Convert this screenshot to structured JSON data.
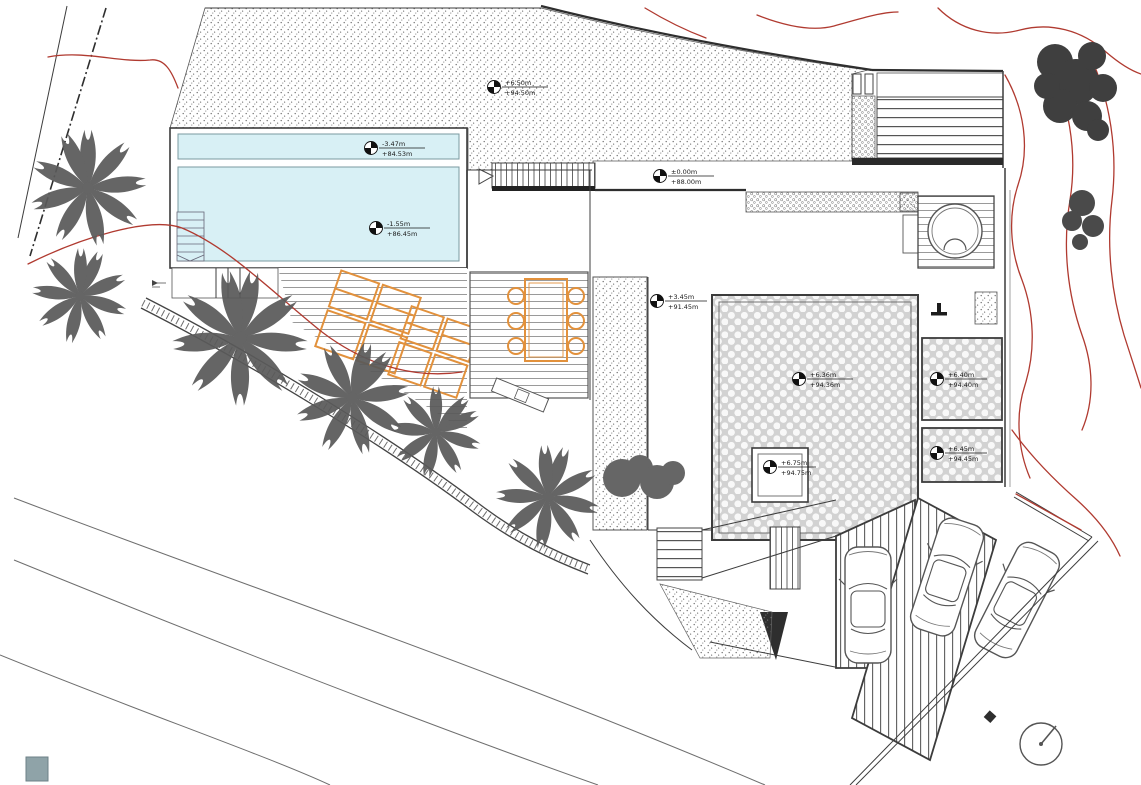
{
  "title": "villa-site-plan-drawing",
  "colors": {
    "canvas": "#ffffff",
    "pool_water": "#d8f0f5",
    "lounger_orange": "#e2913c",
    "contour_red": "#b03a30",
    "linework": "#3c3c3c",
    "vegetation_gray": "#5a5a5a",
    "paving_gray": "#d4d4d4"
  },
  "icons": {
    "level_marker": "level-marker-icon",
    "north_arrow": "north-arrow-icon"
  },
  "markers": {
    "garden_upper": {
      "rel": "+6.50m",
      "abs": "+94.50m"
    },
    "pool_lounge": {
      "rel": "-3.47m",
      "abs": "+84.53m"
    },
    "pool_main": {
      "rel": "-1.55m",
      "abs": "+86.45m"
    },
    "terrace_entry": {
      "rel": "±0.00m",
      "abs": "+88.00m"
    },
    "garden_mid": {
      "rel": "+3.45m",
      "abs": "+91.45m"
    },
    "roof_patio": {
      "rel": "+6.36m",
      "abs": "+94.36m"
    },
    "skylight": {
      "rel": "+6.75m",
      "abs": "+94.75m"
    },
    "roof_room_a": {
      "rel": "+6.40m",
      "abs": "+94.40m"
    },
    "roof_room_b": {
      "rel": "+6.45m",
      "abs": "+94.45m"
    }
  }
}
